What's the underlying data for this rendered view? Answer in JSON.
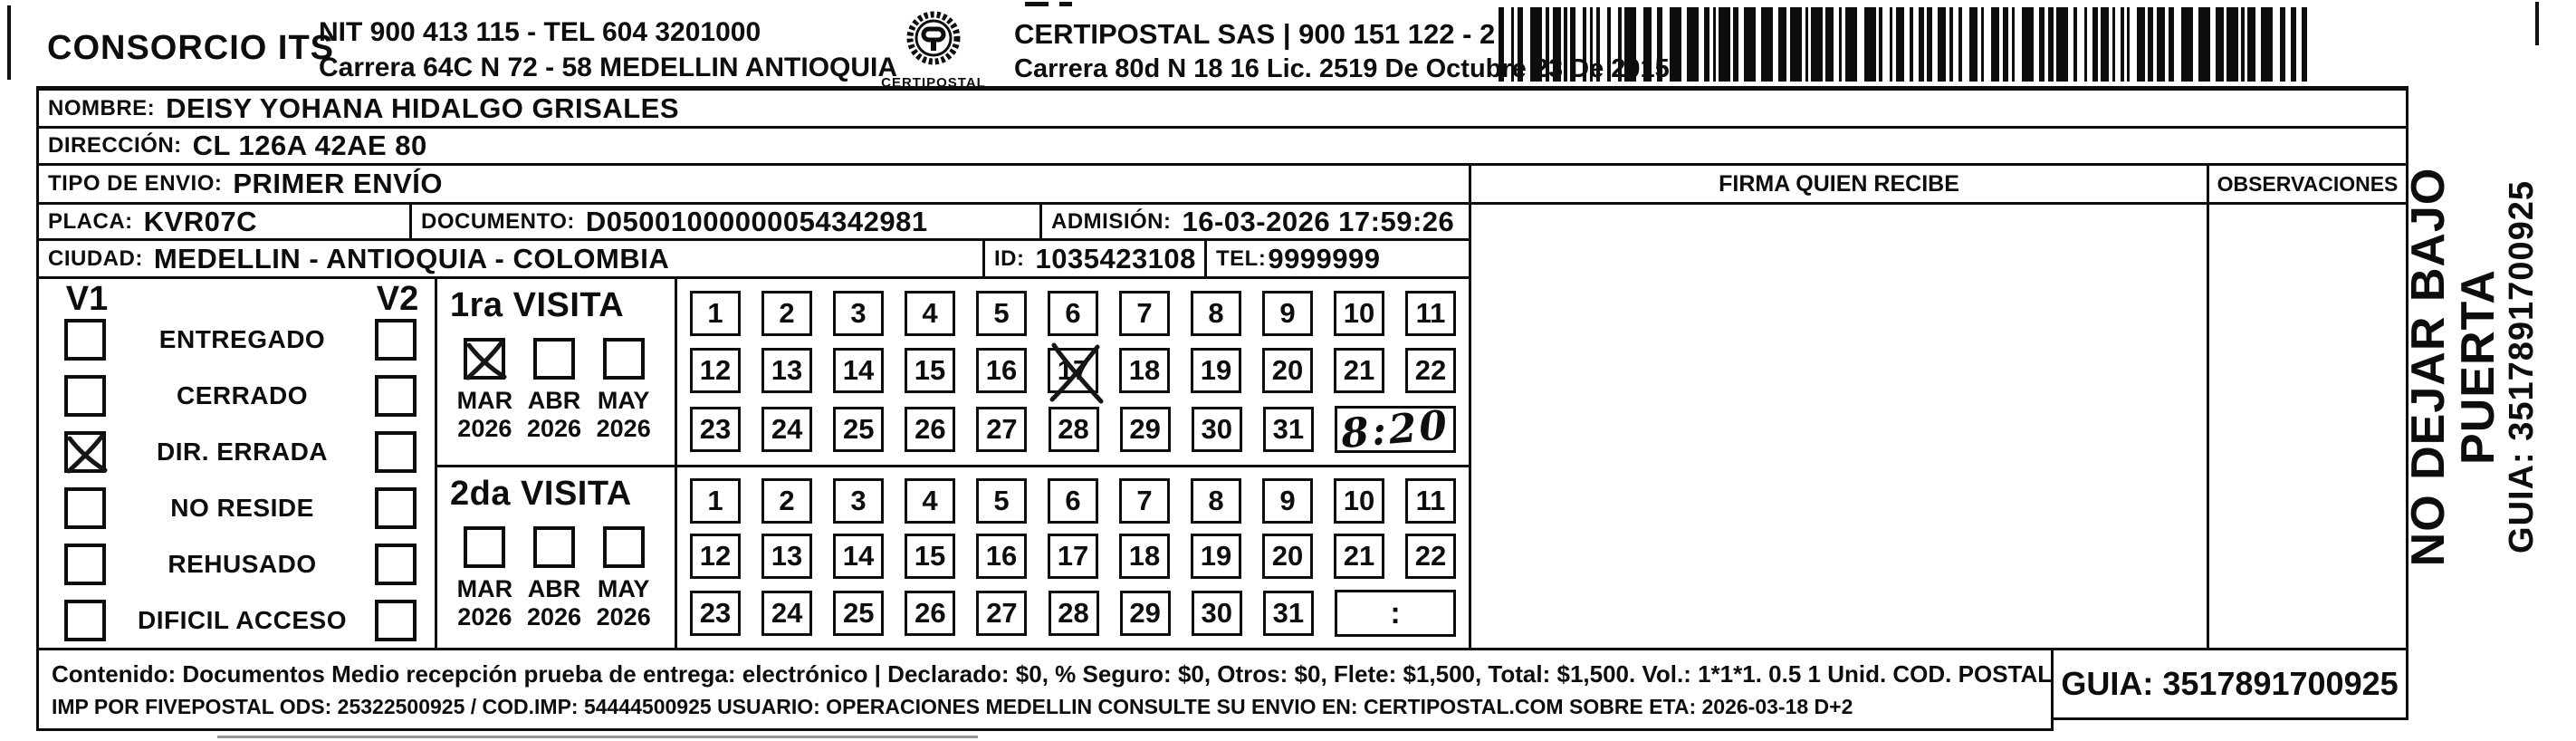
{
  "header": {
    "company": "CONSORCIO ITS",
    "company_info_line1": "NIT 900 413 115 - TEL 604 3201000",
    "company_info_line2": "Carrera 64C N 72 - 58 MEDELLIN ANTIOQUIA",
    "logo_text": "CERTIPOSTAL",
    "carrier_line1": "CERTIPOSTAL SAS | 900 151 122 - 2",
    "carrier_line2": "Carrera 80d N 18 16  Lic. 2519 De Octubre 23 De 2015"
  },
  "shipment": {
    "nombre_label": "NOMBRE:",
    "nombre": "DEISY YOHANA HIDALGO GRISALES",
    "direccion_label": "DIRECCIÓN:",
    "direccion": "CL 126A 42AE 80",
    "tipo_envio_label": "TIPO DE ENVIO:",
    "tipo_envio": "PRIMER ENVÍO",
    "placa_label": "PLACA:",
    "placa": "KVR07C",
    "documento_label": "DOCUMENTO:",
    "documento": "D05001000000054342981",
    "admision_label": "ADMISIÓN:",
    "admision": "16-03-2026 17:59:26",
    "ciudad_label": "CIUDAD:",
    "ciudad": "MEDELLIN - ANTIOQUIA - COLOMBIA",
    "id_label": "ID:",
    "id": "1035423108",
    "tel_label": "TEL:",
    "tel": "9999999"
  },
  "columns": {
    "firma": "FIRMA QUIEN RECIBE",
    "observaciones": "OBSERVACIONES"
  },
  "delivery_status": {
    "col1": "V1",
    "col2": "V2",
    "options": [
      {
        "label": "ENTREGADO",
        "v1": false,
        "v2": false
      },
      {
        "label": "CERRADO",
        "v1": false,
        "v2": false
      },
      {
        "label": "DIR. ERRADA",
        "v1": true,
        "v2": false
      },
      {
        "label": "NO RESIDE",
        "v1": false,
        "v2": false
      },
      {
        "label": "REHUSADO",
        "v1": false,
        "v2": false
      },
      {
        "label": "DIFICIL ACCESO",
        "v1": false,
        "v2": false
      }
    ]
  },
  "visits": [
    {
      "title": "1ra VISITA",
      "months": [
        {
          "month": "MAR",
          "year": "2026",
          "checked": true
        },
        {
          "month": "ABR",
          "year": "2026",
          "checked": false
        },
        {
          "month": "MAY",
          "year": "2026",
          "checked": false
        }
      ],
      "day_rows": [
        [
          "1",
          "2",
          "3",
          "4",
          "5",
          "6",
          "7",
          "8",
          "9",
          "10",
          "11"
        ],
        [
          "12",
          "13",
          "14",
          "15",
          "16",
          "17",
          "18",
          "19",
          "20",
          "21",
          "22"
        ],
        [
          "23",
          "24",
          "25",
          "26",
          "27",
          "28",
          "29",
          "30",
          "31"
        ]
      ],
      "crossed_day": "17",
      "time": "8:20",
      "time_handwritten": true
    },
    {
      "title": "2da VISITA",
      "months": [
        {
          "month": "MAR",
          "year": "2026",
          "checked": false
        },
        {
          "month": "ABR",
          "year": "2026",
          "checked": false
        },
        {
          "month": "MAY",
          "year": "2026",
          "checked": false
        }
      ],
      "day_rows": [
        [
          "1",
          "2",
          "3",
          "4",
          "5",
          "6",
          "7",
          "8",
          "9",
          "10",
          "11"
        ],
        [
          "12",
          "13",
          "14",
          "15",
          "16",
          "17",
          "18",
          "19",
          "20",
          "21",
          "22"
        ],
        [
          "23",
          "24",
          "25",
          "26",
          "27",
          "28",
          "29",
          "30",
          "31"
        ]
      ],
      "crossed_day": "",
      "time": ":",
      "time_handwritten": false
    }
  ],
  "side_note": {
    "line1": "NO DEJAR BAJO PUERTA",
    "line2": "GUIA: 3517891700925"
  },
  "footer": {
    "line1": "Contenido: Documentos Medio recepción prueba de entrega: electrónico | Declarado: $0, % Seguro: $0, Otros: $0, Flete: $1,500, Total: $1,500. Vol.: 1*1*1. 0.5  1 Unid. COD. POSTAL: 050015",
    "line2": "IMP POR FIVEPOSTAL ODS: 25322500925 / COD.IMP: 54444500925 USUARIO: OPERACIONES MEDELLIN CONSULTE SU ENVIO EN: CERTIPOSTAL.COM SOBRE ETA: 2026-03-18 D+2",
    "guia": "GUIA: 3517891700925"
  },
  "colors": {
    "ink": "#0d0d0d",
    "paper": "#ffffff"
  }
}
